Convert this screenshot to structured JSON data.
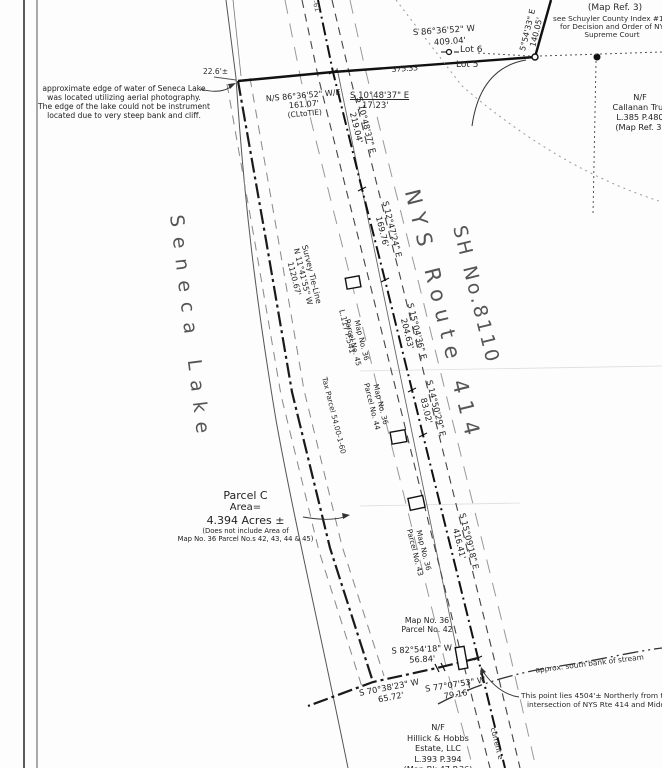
{
  "corner_note": {
    "clipped_word": "Callanan",
    "map_ref": "(Map Ref. 3)",
    "line1": "see Schuyler County Index #16-",
    "line2": "for Decision and Order of NY",
    "line3": "Supreme Court"
  },
  "north_line": {
    "bearing": "5°54'33\" E",
    "distance": "140.05'"
  },
  "lot_line": {
    "bearing": "S 86°36'52\" W",
    "distance": "409.04'",
    "lot6": "Lot 6",
    "lot5": "Lot 5",
    "partial_distance": "375.33'"
  },
  "tie": {
    "offset": "22.6'±",
    "bearing": "N/S 86°36'52\" W/E",
    "distance": "161.07'",
    "note": "(CLtoTIE)",
    "spur_bearing": "S 10°48'37\" E",
    "spur_distance": "17.23'"
  },
  "lake": {
    "name": "Seneca Lake",
    "note_line1": "approximate edge of water of Seneca Lake",
    "note_line2": "was located utilizing aerial photography.",
    "note_line3": "The edge of the lake could not be instrument",
    "note_line4": "located due to very steep bank and cliff."
  },
  "road": {
    "name": "NYS Route 414",
    "sh_number": "SH No.8110",
    "seg1": {
      "bearing": "S 10°48'37\" E",
      "distance": "219.04'"
    },
    "seg2": {
      "bearing": "S 12°47'24\" E",
      "distance": "169.76'"
    },
    "seg3": {
      "bearing": "S 15°04'36\" E",
      "distance": "204.63'"
    },
    "seg4": {
      "bearing": "S 14°50'29\" E",
      "distance": "83.02'"
    },
    "seg5": {
      "bearing": "S 15°09'18\" E",
      "distance": "416.41'"
    },
    "edge_fragment": "-61",
    "current_note": "current e"
  },
  "survey_tie": {
    "label": "Survey Tie-Line",
    "bearing": "N 11°41'55\" W",
    "distance": "1120.67'"
  },
  "refs": {
    "deed": "L.117 P.541",
    "tax_parcel": "Tax Parcel 54.00-1-60"
  },
  "parcel_c": {
    "name": "Parcel C",
    "area_label": "Area=",
    "area": "4.394 Acres ±",
    "exclusion1": "(Does not include Area of",
    "exclusion2": "Map No. 36 Parcel No.s 42, 43, 44 & 45)"
  },
  "map_parcels": {
    "p45": {
      "line1": "Map No. 36",
      "line2": "Parcel No. 45"
    },
    "p44": {
      "line1": "Map No. 36",
      "line2": "Parcel No. 44"
    },
    "p43": {
      "line1": "Map No. 36",
      "line2": "Parcel No. 43"
    },
    "p42": {
      "line1": "Map No. 36",
      "line2": "Parcel No. 42"
    }
  },
  "south_line": {
    "course1": {
      "bearing": "S 82°54'18\" W",
      "distance": "56.84'"
    },
    "course2": {
      "bearing": "S 77°07'53\" W",
      "distance": "79.16'"
    },
    "course3": {
      "bearing": "S 70°38'23\" W",
      "distance": "65.72'"
    }
  },
  "stream": {
    "bank_label": "approx. south bank of stream",
    "point_note1": "This point lies 4504'± Northerly from the ce",
    "point_note2": "intersection of NYS Rte 414 and Middle Rd"
  },
  "owners": {
    "callanan": {
      "nf": "N/F",
      "name": "Callanan Trus",
      "deed": "L.385 P.480",
      "map_ref": "(Map Ref. 3)"
    },
    "hillick": {
      "nf": "N/F",
      "name": "Hillick & Hobbs",
      "name2": "Estate, LLC",
      "deed": "L.393 P.394",
      "map_ref": "(Map Bk 47 P.36)"
    }
  },
  "colors": {
    "ink": "#1f1f1f",
    "faint": "#888888",
    "paper": "#fdfdfd"
  }
}
